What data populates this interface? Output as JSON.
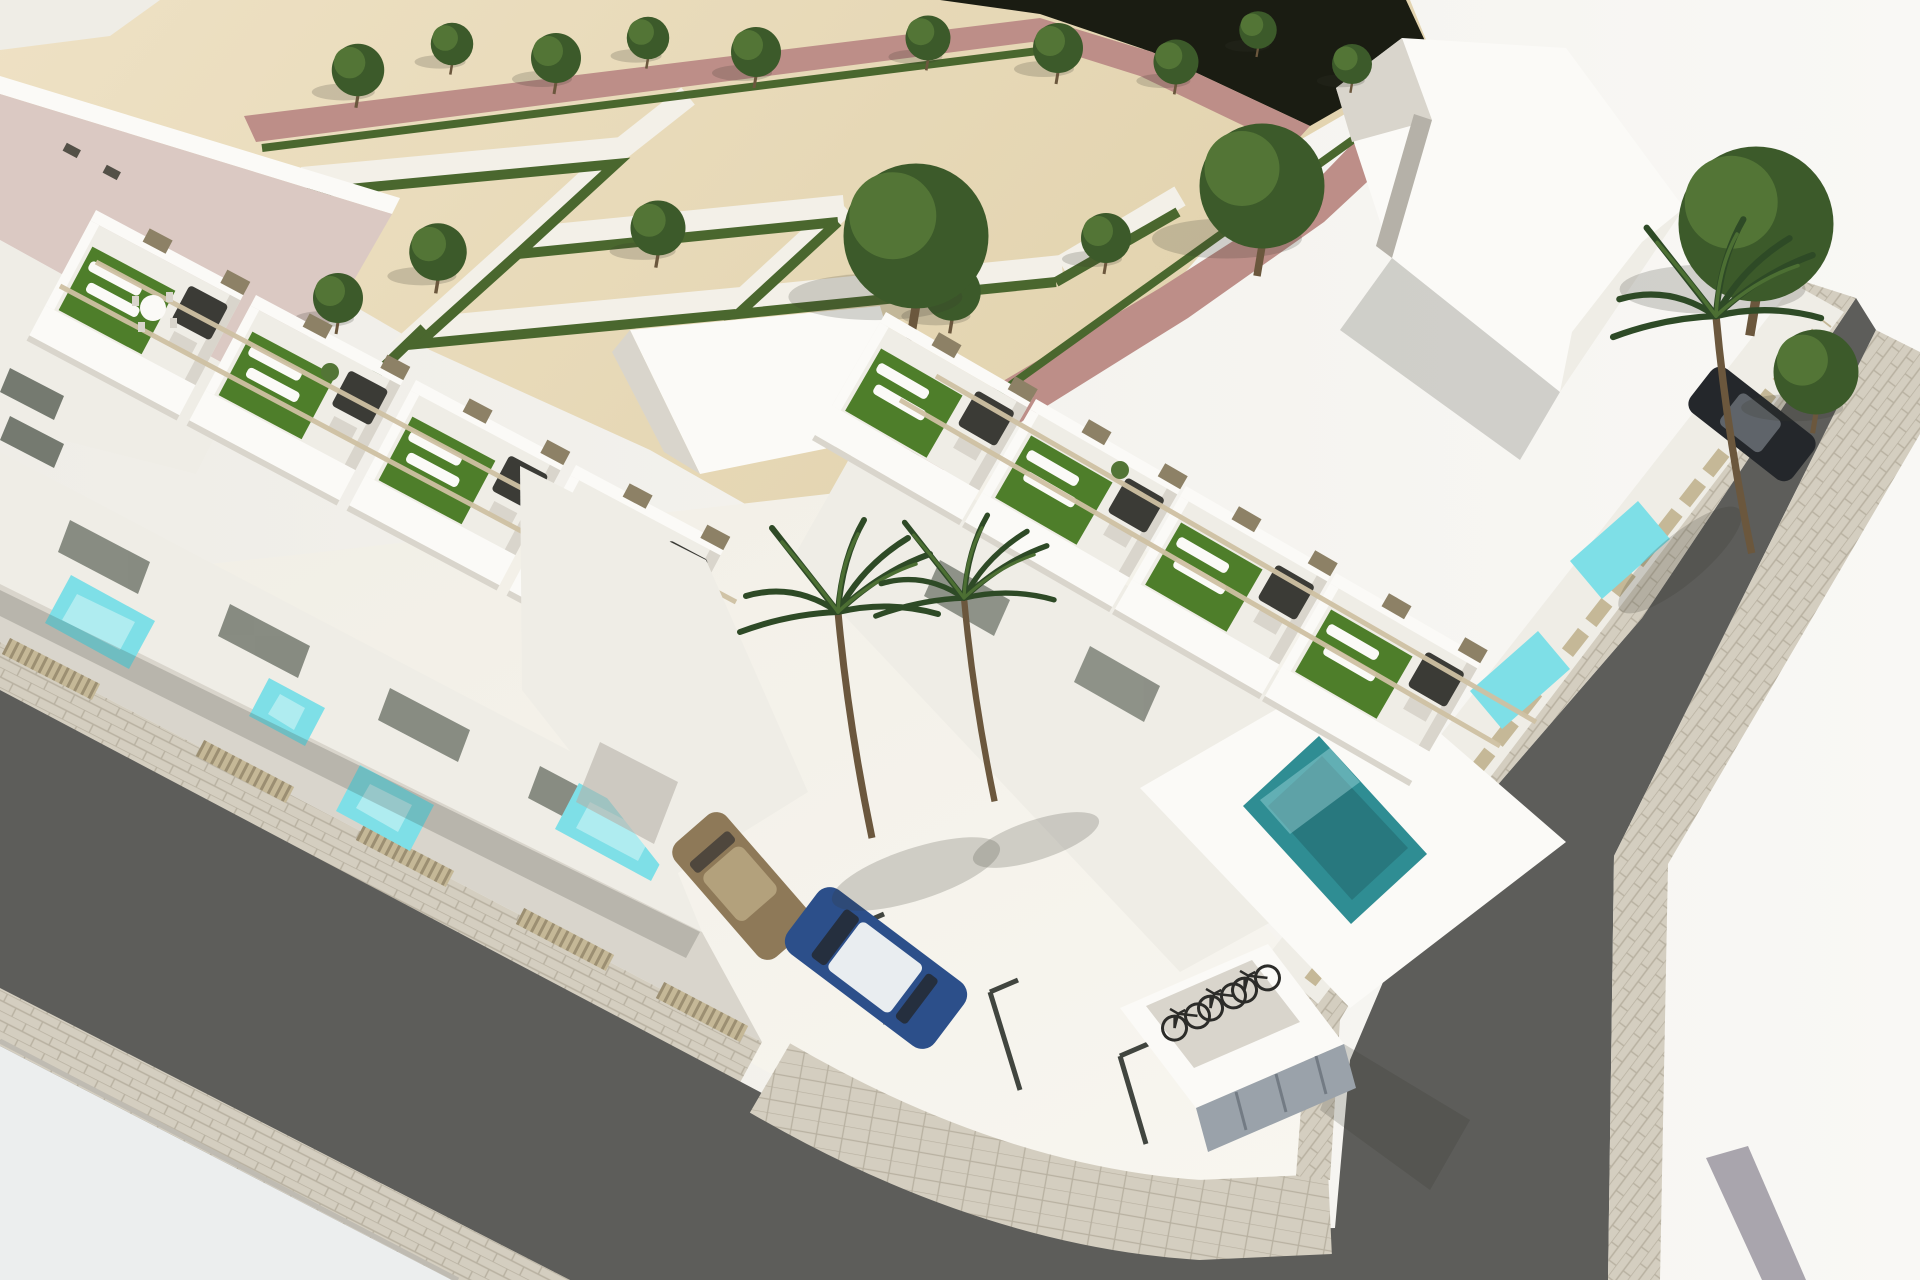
{
  "scene": {
    "kind": "3d-architectural-render",
    "view": "aerial-corner-perspective",
    "subject": "new-build development of white modern townhouses with rooftop terraces, private plunge pools, corner parking court, bike shelter, formal hedge park and surrounding streets",
    "counts": {
      "townhouse_roof_terraces": 8,
      "trees": 19,
      "palm_trees": 3,
      "private_pools_turquoise": 6,
      "plunge_pool_teal": 1,
      "parked_cars": 3,
      "bicycles": 3
    }
  },
  "colors": {
    "sandLight": "#eee1c4",
    "sand": "#e2d3ae",
    "plaza": "#efede7",
    "plazaBright": "#f9f8f5",
    "court": "#f1eee5",
    "courtBright": "#f8f6f0",
    "darkBand": "#1a1c12",
    "pinkPath": "#bd8e88",
    "roofPink": "#dbc9c3",
    "parkPath": "#f3f0e8",
    "hedge": "#4a672e",
    "treeDark": "#3c5a2a",
    "treeMid": "#537536",
    "trunk": "#6b573d",
    "palmGreen": "#2e4a26",
    "palmLight": "#4c6f33",
    "white": "#fbfaf7",
    "wallLight": "#efede6",
    "wallShade": "#d9d5cc",
    "wallDark": "#b5b1a8",
    "glass": "#757a70",
    "beige": "#c5b897",
    "beigeDark": "#8d8166",
    "turf": "#4e7e2a",
    "sofa": "#3b3b36",
    "pool": "#7edfe7",
    "poolLight": "#c4f1f4",
    "poolTeal": "#2f8d93",
    "poolTealDark": "#256f75",
    "road": "#5d5d5a",
    "sidewalk": "#d4cec0",
    "sidewalkLine": "#b8b1a1",
    "pavement": "#eceeee",
    "curb": "#bfbbb2",
    "beam": "#cfc1a3",
    "carGold": "#8e7958",
    "carGoldLight": "#b3a17c",
    "carBlue": "#2c4f8a",
    "carRoof": "#e9edf0",
    "carDark": "#24272b",
    "bike": "#2c2c29",
    "shelterGray": "#9aa2aa",
    "shelterDark": "#737b84",
    "stripe": "#a9a5ad",
    "mark": "#41453f",
    "shadow": "rgba(55,53,45,0.20)"
  }
}
